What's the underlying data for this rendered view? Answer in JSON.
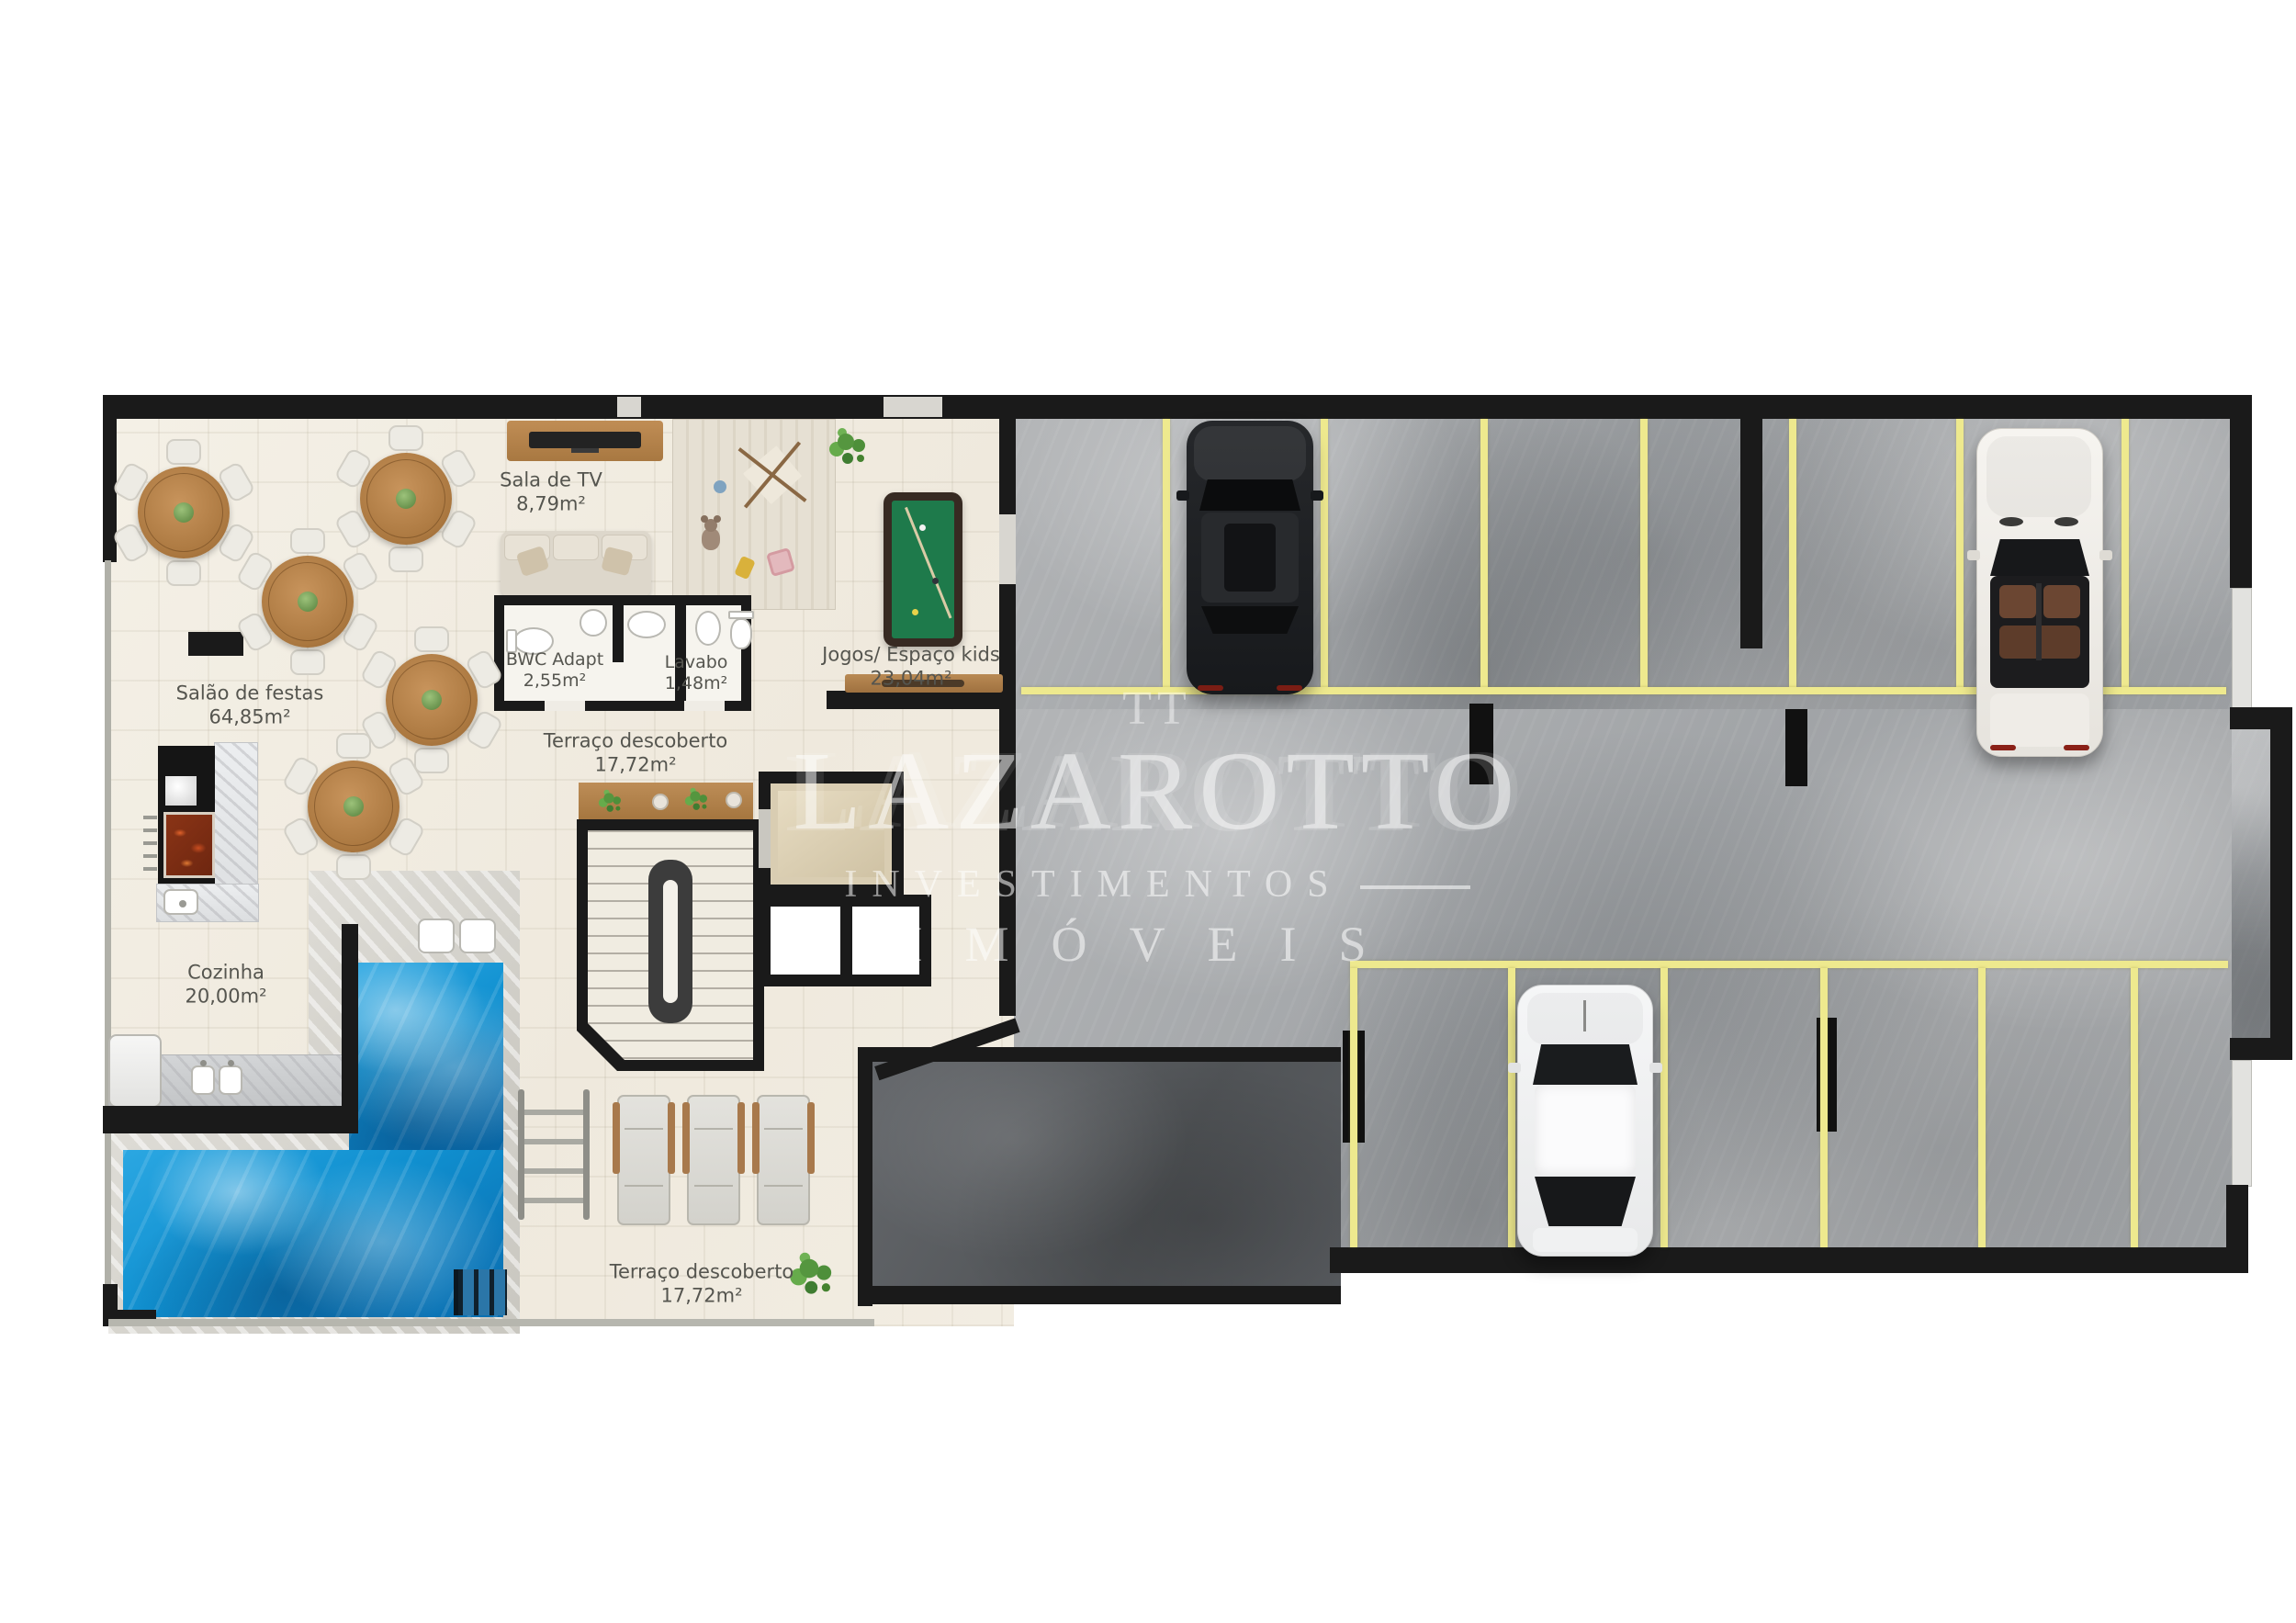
{
  "watermark": {
    "logo": "TT",
    "line1": "LAZAROTTO",
    "line2": "INVESTIMENTOS",
    "line3": "IMÓVEIS"
  },
  "rooms": [
    {
      "name": "Sala de TV",
      "area": "8,79m²"
    },
    {
      "name": "Salão de festas",
      "area": "64,85m²"
    },
    {
      "name": "BWC Adapt",
      "area": "2,55m²"
    },
    {
      "name": "Lavabo",
      "area": "1,48m²"
    },
    {
      "name": "Jogos/ Espaço kids",
      "area": "23,04m²"
    },
    {
      "name": "Terraço descoberto",
      "area": "17,72m²"
    },
    {
      "name": "Cozinha",
      "area": "20,00m²"
    },
    {
      "name": "Terraço descoberto",
      "area": "17,72m²"
    }
  ],
  "colors": {
    "wall": "#1a1a1a",
    "amenity_floor": "#f2eee4",
    "garage_floor": "#a7a9ac",
    "ramp_floor": "#595c60",
    "parking_line": "#eee98e",
    "pool_water": "#1090d0",
    "wood": "#ae7c48",
    "label_text": "#55554f",
    "watermark_text": "#ffffff"
  },
  "vehicles": [
    {
      "type": "suv",
      "color": "black",
      "position": "upper-left parking row"
    },
    {
      "type": "convertible",
      "color": "white",
      "position": "upper-right parking row"
    },
    {
      "type": "sedan",
      "color": "white",
      "position": "lower parking row"
    }
  ]
}
